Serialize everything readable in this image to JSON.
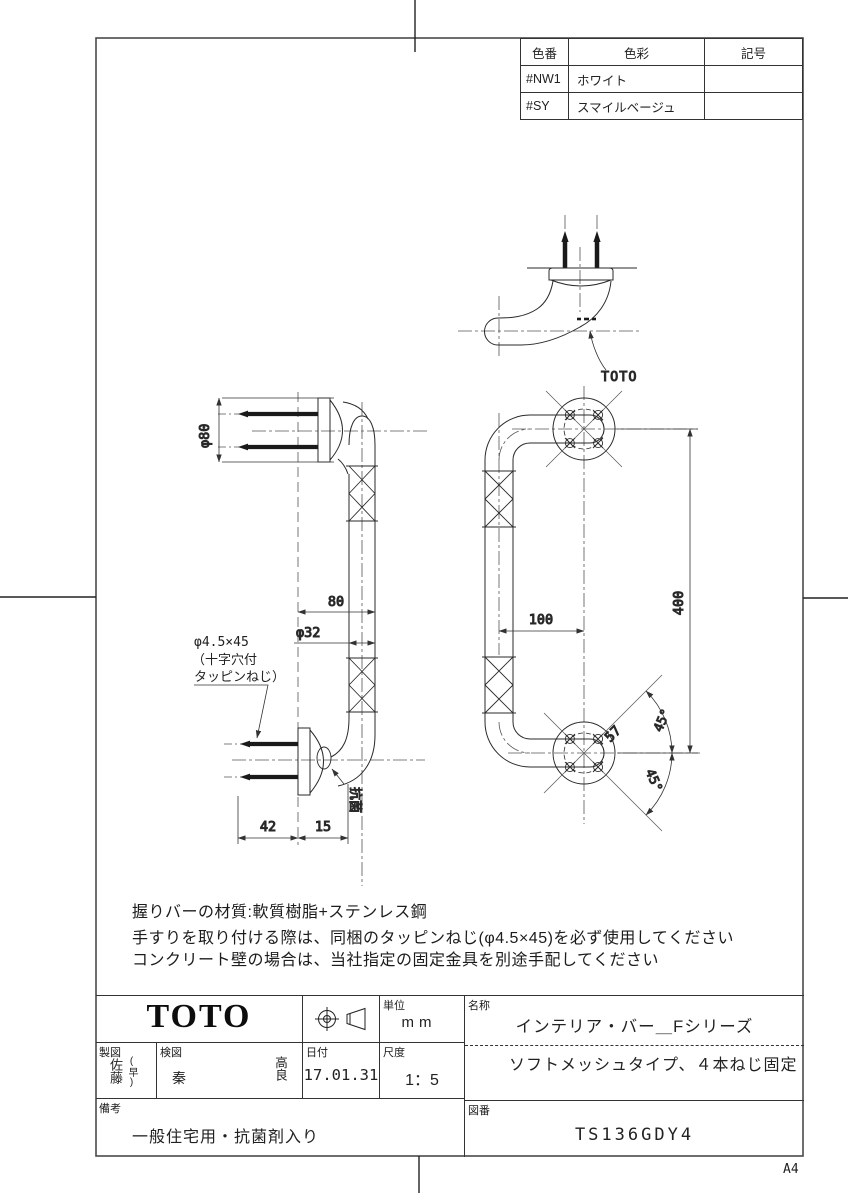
{
  "page": {
    "size_label": "A4"
  },
  "color_table": {
    "headers": [
      "色番",
      "色彩",
      "記号"
    ],
    "rows": [
      [
        "#NW1",
        "ホワイト",
        ""
      ],
      [
        "#SY",
        "スマイルベージュ",
        ""
      ]
    ]
  },
  "drawing": {
    "top_view": {
      "logo_label": "TOTO"
    },
    "side_view": {
      "dim_phi80": "φ80",
      "dim_80": "80",
      "dim_phi32": "φ32",
      "screw_note_line1": "φ4.5×45",
      "screw_note_line2": "（十字穴付",
      "screw_note_line3": "タッピンねじ）",
      "antibacterial_label": "抗菌",
      "dim_42": "42",
      "dim_15": "15"
    },
    "front_view": {
      "dim_100": "100",
      "dim_400": "400",
      "dim_57": "57",
      "dim_45_top": "45°",
      "dim_45_bottom": "45°"
    }
  },
  "notes": {
    "line1": "握りバーの材質:軟質樹脂+ステンレス鋼",
    "line2": "手すりを取り付ける際は、同梱のタッピンねじ(φ4.5×45)を必ず使用してください",
    "line3": "コンクリート壁の場合は、当社指定の固定金具を別途手配してください"
  },
  "title_block": {
    "logo": "TOTO",
    "unit_label": "単位",
    "unit_value": "mm",
    "drafter_label": "製図",
    "drafter_name": "佐藤",
    "drafter_suffix": "(早)",
    "checker_label": "検図",
    "checker_name1": "秦",
    "checker_name2": "高良",
    "date_label": "日付",
    "date_value": "17.01.31",
    "scale_label": "尺度",
    "scale_value": "1：5",
    "name_label": "名称",
    "name_value": "インテリア・バー＿Fシリーズ",
    "type_value": "ソフトメッシュタイプ、４本ねじ固定",
    "remarks_label": "備考",
    "remarks_value": "一般住宅用・抗菌剤入り",
    "number_label": "図番",
    "number_value": "TS136GDY4"
  }
}
